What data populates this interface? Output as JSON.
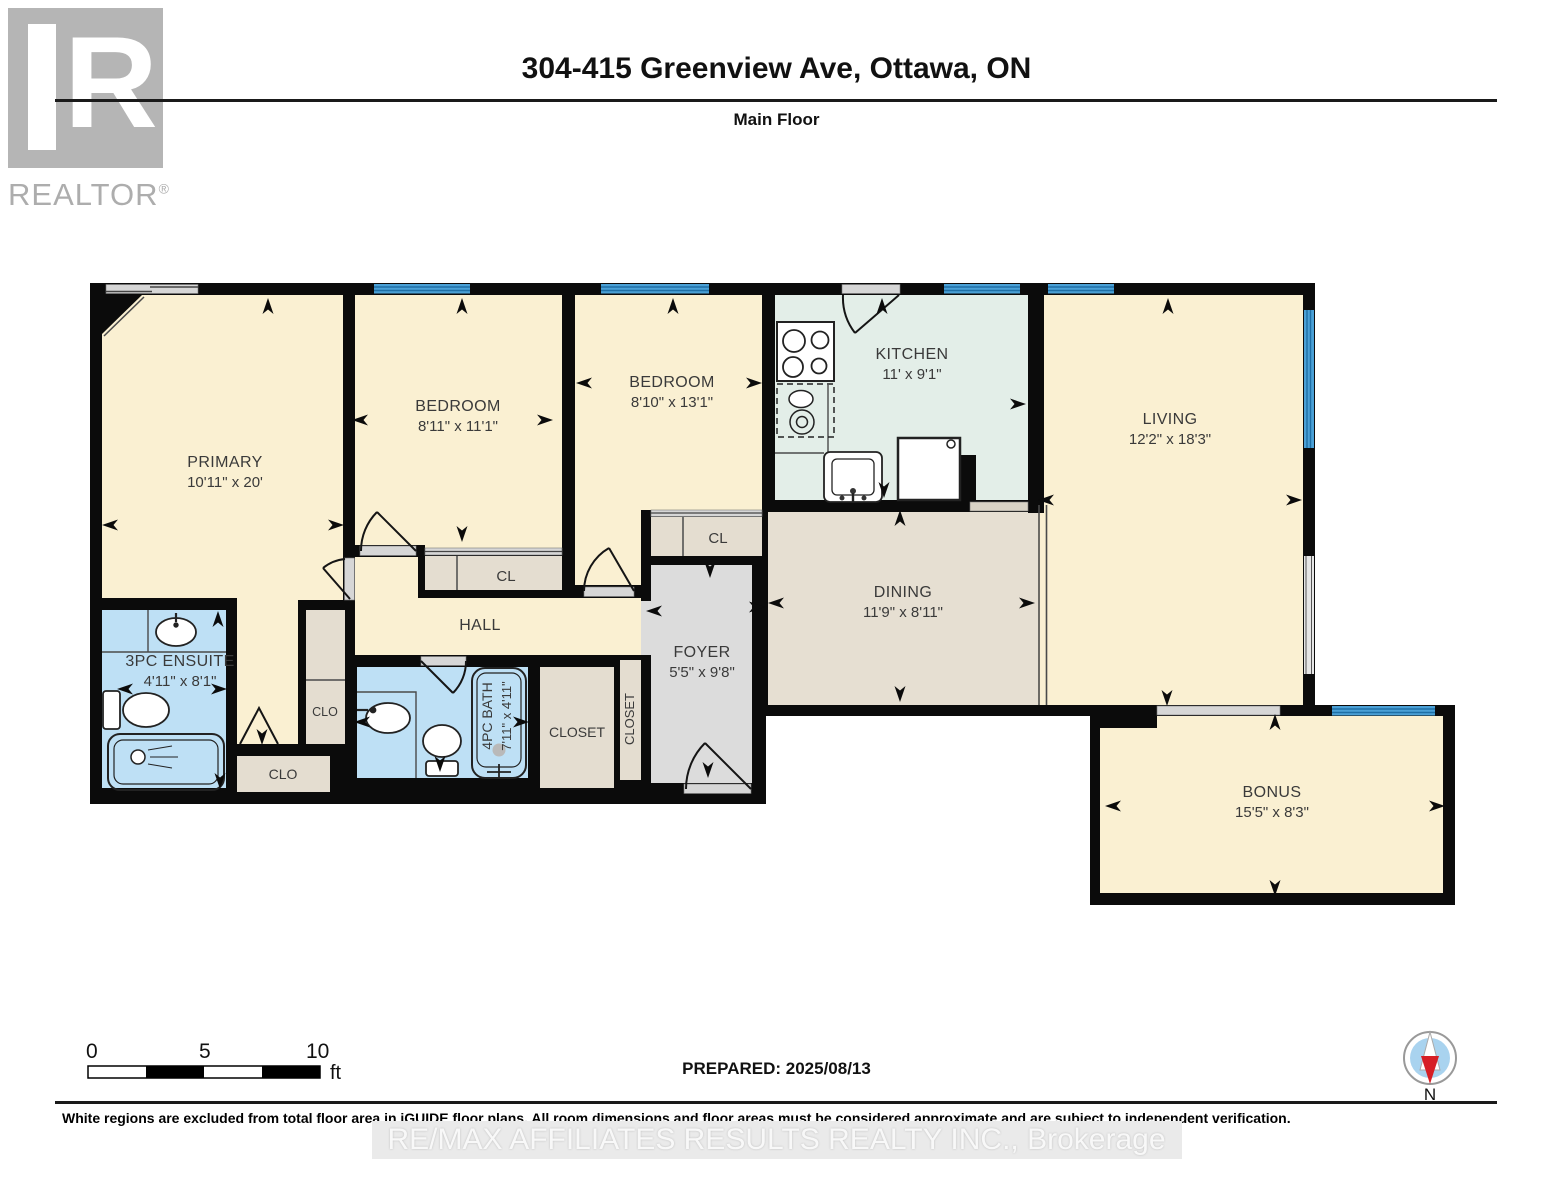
{
  "header": {
    "title": "304-415 Greenview Ave, Ottawa, ON",
    "subtitle": "Main Floor",
    "logo": {
      "letter": "R",
      "word": "REALTOR",
      "reg": "®"
    }
  },
  "plan": {
    "rooms": [
      {
        "id": "primary",
        "name": "PRIMARY",
        "dims": "10'11\" x 20'"
      },
      {
        "id": "bedroom1",
        "name": "BEDROOM",
        "dims": "8'11\" x 11'1\""
      },
      {
        "id": "bedroom2",
        "name": "BEDROOM",
        "dims": "8'10\" x 13'1\""
      },
      {
        "id": "kitchen",
        "name": "KITCHEN",
        "dims": "11' x 9'1\""
      },
      {
        "id": "living",
        "name": "LIVING",
        "dims": "12'2\" x 18'3\""
      },
      {
        "id": "dining",
        "name": "DINING",
        "dims": "11'9\" x 8'11\""
      },
      {
        "id": "foyer",
        "name": "FOYER",
        "dims": "5'5\" x 9'8\""
      },
      {
        "id": "ensuite",
        "name": "3PC ENSUITE",
        "dims": "4'11\" x 8'1\""
      },
      {
        "id": "bath",
        "name": "4PC BATH",
        "dims": "7'11\" x 4'11\""
      },
      {
        "id": "bonus",
        "name": "BONUS",
        "dims": "15'5\" x 8'3\""
      },
      {
        "id": "hall",
        "name": "HALL",
        "dims": ""
      }
    ],
    "closets": {
      "cl_bedroom": "CL",
      "cl_foyer": "CL",
      "clo_hall": "CLO",
      "clo_primary": "CLO",
      "closet_main": "CLOSET",
      "closet_entry": "CLOSET"
    },
    "colors": {
      "wall": "#0b0b0b",
      "room_cream": "#FAF0D2",
      "kitchen_mint": "#E3EEE8",
      "dining_tan": "#E6DFD2",
      "foyer_gray": "#DCDCDC",
      "closet_tan": "#E4DDD0",
      "bath_blue": "#BEE0F5",
      "window_blue": "#4AA0D6",
      "compass_red": "#D61F26"
    }
  },
  "footer": {
    "scale": {
      "start": "0",
      "mid": "5",
      "end": "10",
      "unit": "ft"
    },
    "prepared": "PREPARED: 2025/08/13",
    "compass_label": "N",
    "disclaimer": "White regions are excluded from total floor area in iGUIDE floor plans. All room dimensions and floor areas must be considered approximate and are subject to independent verification.",
    "watermark": "RE/MAX AFFILIATES RESULTS REALTY INC., Brokerage"
  }
}
